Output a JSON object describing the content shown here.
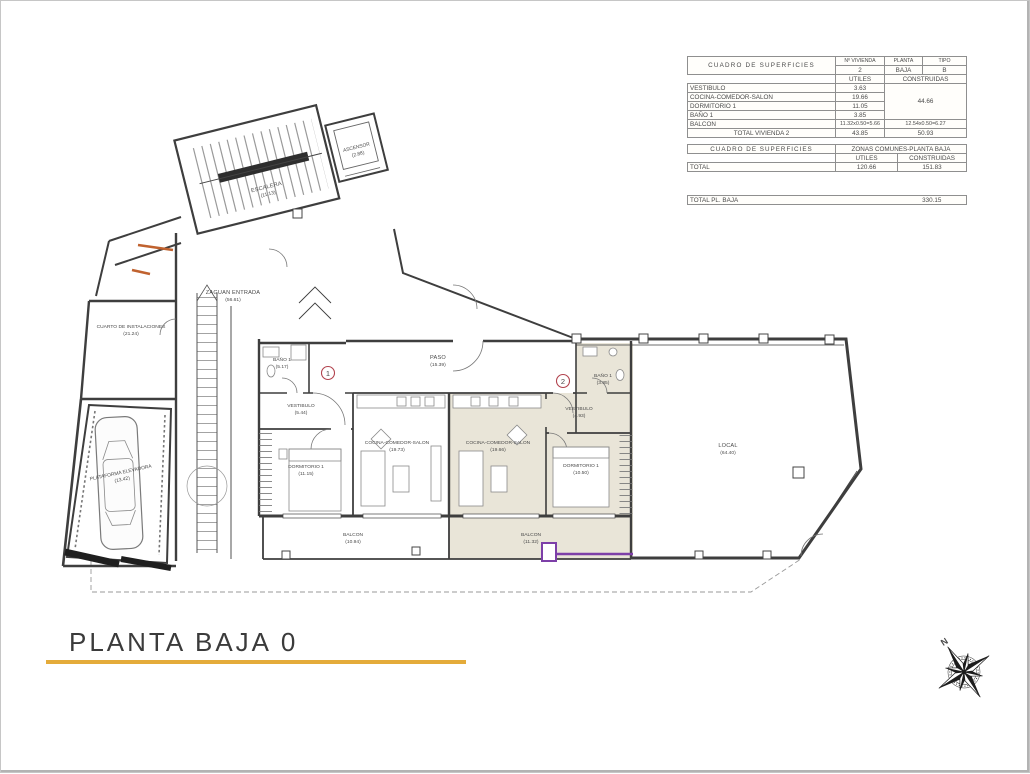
{
  "document": {
    "title": "PLANTA BAJA 0"
  },
  "tables": {
    "superficies_vivienda": {
      "title": "CUADRO DE SUPERFICIES",
      "col_vivienda_label": "Nº VIVIENDA",
      "col_vivienda_value": "2",
      "col_planta_label": "PLANTA",
      "col_planta_value": "BAJA",
      "col_tipo_label": "TIPO",
      "col_tipo_value": "B",
      "col_utiles": "UTILES",
      "col_construidas": "CONSTRUIDAS",
      "rows": [
        {
          "label": "VESTIBULO",
          "utiles": "3.63"
        },
        {
          "label": "COCINA-COMEDOR-SALON",
          "utiles": "19.66"
        },
        {
          "label": "DORMITORIO 1",
          "utiles": "11.05"
        },
        {
          "label": "BAÑO 1",
          "utiles": "3.85"
        }
      ],
      "construidas_group": "44.66",
      "balcon": {
        "label": "BALCON",
        "utiles": "11.32x0.50=5.66",
        "construidas": "12.54x0.50=6.27"
      },
      "total_label": "TOTAL VIVIENDA 2",
      "total_utiles": "43.85",
      "total_construidas": "50.93"
    },
    "superficies_comunes": {
      "title": "CUADRO DE SUPERFICIES",
      "subtitle": "ZONAS COMUNES-PLANTA BAJA",
      "col_utiles": "UTILES",
      "col_construidas": "CONSTRUIDAS",
      "total_label": "TOTAL",
      "total_utiles": "120.66",
      "total_construidas": "151.83"
    },
    "total_planta": {
      "label": "TOTAL PL. BAJA",
      "value": "330.15"
    }
  },
  "plan": {
    "rooms": [
      {
        "name": "ESCALERA",
        "area": "(11.13)"
      },
      {
        "name": "ASCENSOR",
        "area": "(2.88)"
      },
      {
        "name": "ZAGUAN ENTRADA",
        "area": "(56.61)"
      },
      {
        "name": "CUARTO DE INSTALACIONES",
        "area": "(21.24)"
      },
      {
        "name": "PLATAFORMA ELEVADORA",
        "area": "(13.42)"
      },
      {
        "name": "BAÑO 1",
        "area": "(5.17)"
      },
      {
        "name": "VESTIBULO",
        "area": "(5.44)"
      },
      {
        "name": "PASO",
        "area": "(15.39)"
      },
      {
        "name": "DORMITORIO 1",
        "area": "(11.15)"
      },
      {
        "name": "COCINA-COMEDOR-SALON",
        "area": "(19.73)"
      },
      {
        "name": "BALCON",
        "area": "(10.94)"
      },
      {
        "name": "COCINA-COMEDOR-SALON",
        "area": "(19.66)"
      },
      {
        "name": "DORMITORIO 1",
        "area": "(10.50)"
      },
      {
        "name": "VESTIBULO",
        "area": "(4.93)"
      },
      {
        "name": "BAÑO 1",
        "area": "(3.85)"
      },
      {
        "name": "BALCON",
        "area": "(11.32)"
      },
      {
        "name": "LOCAL",
        "area": "(64.40)"
      }
    ],
    "unit_markers": {
      "vivienda1": "1",
      "vivienda2": "2"
    },
    "colors": {
      "vivienda2_shade": "#e9e5d8",
      "highlight_purple": "#7d3fa8",
      "highlight_orange": "#c0622f",
      "marker_red": "#b2434e",
      "title_underline": "#e4ab3a"
    }
  },
  "compass": {
    "north_label": "N"
  }
}
